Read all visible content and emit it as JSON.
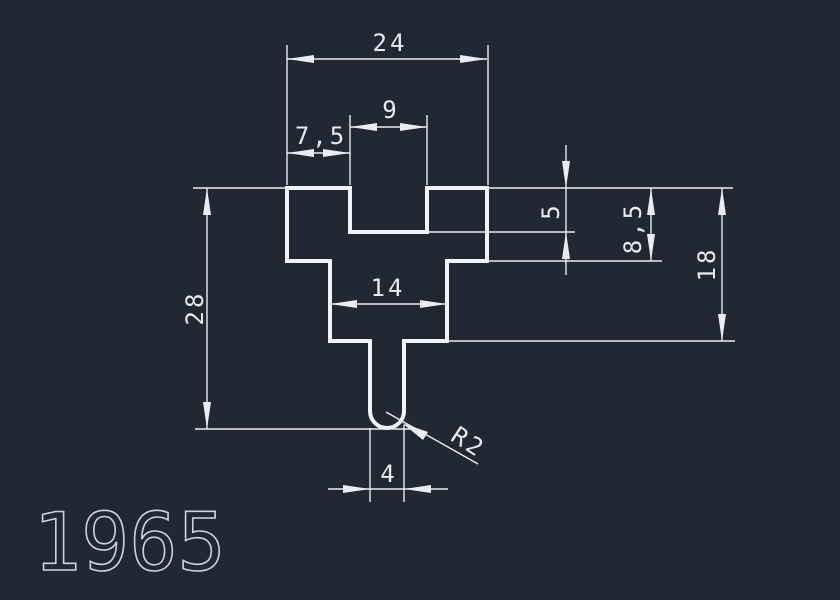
{
  "drawing": {
    "part_number": "1965",
    "dims": {
      "top_width": "24",
      "slot_width": "9",
      "slot_offset": "7,5",
      "slot_depth": "5",
      "step_depth": "8,5",
      "body_height": "18",
      "overall_height": "28",
      "waist_width": "14",
      "stem_width": "4",
      "stem_tip_radius": "R2"
    },
    "colors": {
      "background": "#212833",
      "line": "#f1f4f8",
      "dimension": "#e9edf3",
      "text": "#e6ebf2",
      "part_number_text": "#ccd3de"
    }
  }
}
